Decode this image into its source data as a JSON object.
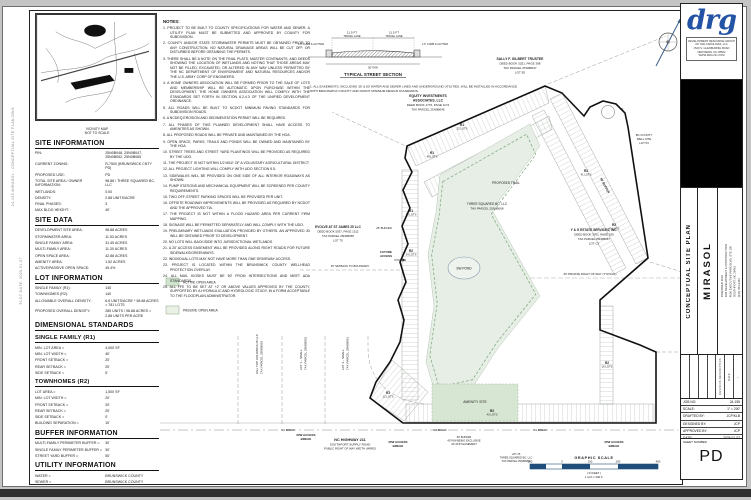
{
  "margin_notes": [
    "24-155 MIRASOL - CONCEPTUAL SITE PLAN.DWG",
    "PLOT DATE: 2025-01-07"
  ],
  "vicinity": {
    "caption": "VICINITY MAP",
    "scale_note": "NOT TO SCALE"
  },
  "sidebar": {
    "site_information": {
      "title": "SITE INFORMATION",
      "rows": [
        {
          "label": "PIN:",
          "value": "25N0B048, 25N0B047, 25N0B052, 25N0B065"
        },
        {
          "label": "CURRENT ZONING:",
          "value": "R-7500 (BRUNSWICK CNTY PD)"
        },
        {
          "label": "PROPOSED USE:",
          "value": "PD"
        },
        {
          "label": "TOTAL SITE AREA / OWNER INFORMATION:",
          "value": "98.88 / THREE SQUARED BC, LLC"
        },
        {
          "label": "WETLANDS:",
          "value": "0.00"
        },
        {
          "label": "DENSITY:",
          "value": "2.88 UNITS/ACRE"
        },
        {
          "label": "FINAL PHASES:",
          "value": "3"
        },
        {
          "label": "MAX BLDG HEIGHT:",
          "value": "40'"
        }
      ]
    },
    "site_data": {
      "title": "SITE DATA",
      "rows": [
        {
          "label": "DEVELOPMENT SITE AREA:",
          "value": "98.88 ACRES"
        },
        {
          "label": "STORMWATER AREA:",
          "value": "11.53 ACRES"
        },
        {
          "label": "SINGLE FAMILY AREA:",
          "value": "31.45 ACRES"
        },
        {
          "label": "MULTI-FAMILY AREA:",
          "value": "11.30 ACRES"
        },
        {
          "label": "OPEN SPACE AREA:",
          "value": "42.88 ACRES"
        },
        {
          "label": "AMENITY AREA:",
          "value": "1.52 ACRES"
        },
        {
          "label": "ACTIVE/PASSIVE OPEN SPACE:",
          "value": "49.4%"
        }
      ]
    },
    "lot_information": {
      "title": "LOT INFORMATION",
      "rows": [
        {
          "label": "SINGLE FAMILY (R1):",
          "value": "145"
        },
        {
          "label": "TOWNHOMES (R2):",
          "value": "140"
        },
        {
          "label": "ALLOWABLE OVERALL DENSITY:",
          "value": "6.8 UNITS/ACRE * 98.88 ACRES = 781 LOTS"
        },
        {
          "label": "PROPOSED OVERALL DENSITY:",
          "value": "285 UNITS / 98.88 ACRES = 2.88 UNITS PER ACRE"
        }
      ]
    },
    "dimensional_standards_title": "DIMENSIONAL STANDARDS",
    "single_family": {
      "title": "SINGLE FAMILY (R1)",
      "rows": [
        {
          "label": "MIN. LOT AREA =",
          "value": "4,000 SF"
        },
        {
          "label": "MIN. LOT WIDTH =",
          "value": "40'"
        },
        {
          "label": "FRONT SETBACK =",
          "value": "20'"
        },
        {
          "label": "REAR SETBACK =",
          "value": "20'"
        },
        {
          "label": "SIDE SETBACK =",
          "value": "5'"
        }
      ]
    },
    "townhomes": {
      "title": "TOWNHOMES (R2)",
      "rows": [
        {
          "label": "LOT AREA =",
          "value": "1,500 SF"
        },
        {
          "label": "MIN. LOT WIDTH =",
          "value": "20'"
        },
        {
          "label": "FRONT SETBACK =",
          "value": "20'"
        },
        {
          "label": "REAR SETBACK =",
          "value": "20'"
        },
        {
          "label": "SIDE SETBACK =",
          "value": "0'"
        },
        {
          "label": "BUILDING SEPARATION =",
          "value": "10'"
        }
      ]
    },
    "buffer_information": {
      "title": "BUFFER INFORMATION",
      "rows": [
        {
          "label": "MULTI-FAMILY PERIMETER BUFFER =",
          "value": "30'"
        },
        {
          "label": "SINGLE FAMILY PERIMETER BUFFER =",
          "value": "30'"
        },
        {
          "label": "STREET YARD BUFFER =",
          "value": "50'"
        }
      ]
    },
    "utility_information": {
      "title": "UTILITY INFORMATION",
      "rows": [
        {
          "label": "WATER =",
          "value": "BRUNSWICK COUNTY"
        },
        {
          "label": "SEWER =",
          "value": "BRUNSWICK COUNTY"
        }
      ]
    }
  },
  "notes": {
    "title": "NOTES:",
    "items": [
      "1. PROJECT TO BE BUILT TO COUNTY SPECIFICATIONS FOR WATER AND SEWER. A UTILITY PLAN MUST BE SUBMITTED AND APPROVED BY COUNTY FOR SUBDIVISION.",
      "2. COUNTY AND/OR STATE STORMWATER PERMITS MUST BE OBTAINED PRIOR TO ANY CONSTRUCTION. NO NATURAL DRAINAGE AREAS WILL BE CUT OFF OR DISTURBED BEFORE OBTAINING THE PERMITS.",
      "3. THERE SHALL BE A NOTE ON THE FINAL PLATS, MASTER COVENANTS, AND DEEDS SHOWING THE LOCATION OF WETLANDS AND NOTING THAT THOSE AREAS MAY NOT BE FILLED, EXCAVATED, OR ALTERED IN ANY WAY UNLESS PERMITTED BY THE NC DEPARTMENT OF ENVIRONMENT AND NATURAL RESOURCES AND/OR THE U.S. ARMY CORP OF ENGINEERS.",
      "4. A HOME OWNERS ASSOCIATION WILL BE FORMED PRIOR TO THE SALE OF LOTS AND MEMBERSHIP WILL BE AUTOMATIC UPON PURCHASE WITHIN THE DEVELOPMENT. THE HOME OWNERS ASSOCIATION WILL COMPLY WITH THE STANDARDS SET FORTH IN SECTION 6.2.4.3 OF THE UNIFIED DEVELOPMENT ORDINANCE.",
      "5. ALL ROADS WILL BE BUILT TO NCDOT MINIMUM PAVING STANDARDS FOR SUBDIVISION ROADS.",
      "6. A NCDEQ EROSION AND SEDIMENTATION PERMIT WILL BE REQUIRED.",
      "7. ALL PHASES OF THIS PLANNED DEVELOPMENT SHALL HAVE ACCESS TO AMENITIES AS SHOWN.",
      "8. ALL PROPOSED ROADS WILL BE PRIVATE AND MAINTAINED BY THE HOA.",
      "9. OPEN SPACE, PARKS, TRAILS AND PONDS WILL BE OWNED AND MAINTAINED BY THE HOA.",
      "10. STREET TREES AND STREET YARD PLANTINGS WILL BE PROVIDED AS REQUIRED BY THE UDO.",
      "11. THE PROJECT IS NOT WITHIN 1/2 MILE OF A VOLUNTARY AGRICULTURAL DISTRICT.",
      "12. ALL PROJECT LIGHTING WILL COMPLY WITH UDO SECTION 5.5.",
      "13. SIDEWALKS WILL BE PROVIDED ON ONE SIDE OF ALL INTERIOR ROADWAYS AS SHOWN.",
      "14. PUMP STATIONS AND MECHANICAL EQUIPMENT WILL BE SCREENED PER COUNTY REQUIREMENTS.",
      "15. TWO OFF-STREET PARKING SPACES WILL BE PROVIDED PER UNIT.",
      "16. OFFSITE ROADWAY IMPROVEMENTS WILL BE PROVIDED AS REQUIRED BY NCDOT AND THE APPROVED TIA.",
      "17. THE PROJECT IS NOT WITHIN A FLOOD HAZARD AREA PER CURRENT FIRM MAPPING.",
      "18. SIGNAGE WILL BE PERMITTED SEPARATELY AND WILL COMPLY WITH THE UDO.",
      "19. PRELIMINARY WETLANDS EVALUATION PROVIDED BY OTHERS. AN APPROVED JD WILL BE OBTAINED PRIOR TO DEVELOPMENT.",
      "20. NO LOTS WILL BACK/SIDE INTO JURISDICTIONAL WETLANDS.",
      "21. A 20' ACCESS EASEMENT WILL BE PROVIDED ALONG RIGHT ROADS FOR FUTURE SIDEWALKS/GREENWAYS.",
      "22. INDIVIDUAL LOTS MAY NOT HAVE MORE THAN ONE DRIVEWAY ACCESS.",
      "23. PROJECT IS LOCATED WITHIN THE BRUNSWICK COUNTY WELLHEAD PROTECTION OVERLAY.",
      "24. ALL MAIL KIOSKS MUST BE 50' FROM INTERSECTIONS AND MEET ADA STANDARDS.",
      "25. ALL FFE TO BE SET AT +2' OR ABOVE VALUES APPROVED BY THE COUNTY, SUPPORTED BY A HYDRAULIC AND HYDROLOGIC STUDY, IN A FORM ACCEPTABLE TO THE FLOODPLAIN ADMINISTRATOR."
    ]
  },
  "street_section": {
    "title": "TYPICAL STREET SECTION",
    "lane_left_dim": "11.5 FT",
    "lane_left_name": "TRAVEL LANE",
    "lane_right_dim": "11.5 FT",
    "lane_right_name": "TRAVEL LANE",
    "curb_left": "1.5' CURB & GUTTER",
    "curb_right": "1.5' CURB & GUTTER",
    "bottom_dim": "50' R/W",
    "notes": [
      "1. ALL EASEMENTS, INCLUDING 30' & 50' WATER AND SEWER LINES AND UNDERGROUND UTILITIES, WILL BE INSTALLED IN ACCORDANCE",
      "WITH BRUNSWICK COUNTY AND NCDOT MINIMUM DESIGN STANDARDS."
    ]
  },
  "legend": {
    "items": [
      {
        "label": "ACTIVE OPEN AREA",
        "color": "#cfe3cd"
      },
      {
        "label": "PASSIVE OPEN AREA",
        "color": "#e9f1e7"
      }
    ]
  },
  "plan": {
    "sally": [
      "SALLY F. GILBERT TRUSTEE",
      "DEED BOOK 3251, PAGE 398",
      "TAX PARCEL 25N0B047",
      "LOT 55"
    ],
    "equity": [
      "EQUITY INVESTMENTS",
      "ASSOCIATES, LLC",
      "DEED BOOK 1776, PAGE 1174",
      "TAX PARCEL 25N0B046"
    ],
    "evolve": [
      "EVOLVE AT ST JAMES 25 LLC",
      "DEED BOOK 5037, PAGE 1512",
      "TAX PARCEL 25N0B065",
      "LOT 75"
    ],
    "yg": [
      "Y & G ESTATE SERVICES, INC.",
      "DEED BOOK 3761, PAGE 529",
      "TAX PARCEL 25N0B067",
      "LOT C3"
    ],
    "well": [
      "BC COUNTY",
      "WELL SITE",
      "LOT 54"
    ],
    "owner_center": [
      "THREE SQUARED BC, LLC",
      "TAX PARCEL 25N0B068"
    ],
    "hilltop": [
      "HILL TOP HOLDINGS 25 LLC",
      "TAX PARCEL 25N0B063"
    ],
    "lot1": [
      "LOT 1 - SMALL",
      "TAX PARCEL 25N0B062"
    ],
    "lot2": [
      "LOT 2 - SMALL",
      "TAX PARCEL 25N0B061"
    ],
    "lot25": [
      "LOT 25",
      "THREE SQUARED BC, LLC",
      "TAX PARCEL 25N0B052"
    ],
    "buffer_ne": "50' BUFFER",
    "buffer_left": "25' BUFFER",
    "buffer_bottom": [
      "50' BUFFER",
      "40' R/W BEING EXCLUSIVE",
      "OF AT&T EASEMENT"
    ],
    "future_access": [
      "FUTURE",
      "ACCESS"
    ],
    "setback": "25' SETBACK TO BOUNDARY",
    "private_row": "60' PRIVATE RIGHT OF WAY (TYPICAL)",
    "trail": "PROPOSED TRAIL",
    "pond": "SW POND",
    "amenity": "AMENITY SITE",
    "culdesac": "C1",
    "zones": [
      {
        "z": "R1",
        "n": "22 LOTS"
      },
      {
        "z": "R1",
        "n": "45 LOTS"
      },
      {
        "z": "R1",
        "n": "18 LOTS"
      },
      {
        "z": "R2",
        "n": "14 LOTS"
      },
      {
        "z": "R2",
        "n": "41 LOTS"
      },
      {
        "z": "R2",
        "n": "40 LOTS"
      },
      {
        "z": "R2",
        "n": "16 LOTS"
      },
      {
        "z": "R2",
        "n": "40 LOTS"
      },
      {
        "z": "R1",
        "n": "12 LOTS"
      }
    ],
    "access_break": [
      "R/W ACCESS",
      "BREAK"
    ],
    "cl_break": "C/L BREAK",
    "highway": [
      "NC HIGHWAY 211",
      "SOUTHPORT SUPPLY ROAD",
      "PUBLIC RIGHT OF WAY WIDTH VARIES"
    ]
  },
  "graphic_scale": {
    "title": "GRAPHIC SCALE",
    "ticks": [
      "100",
      "0",
      "100",
      "200",
      "400"
    ],
    "in_feet": "( IN FEET )",
    "ratio": "1 inch = 200 ft.",
    "bar_color": "#1f4e7a"
  },
  "title_block": {
    "logo": "drg",
    "firm_lines": [
      "DEVELOPMENT RESOURCE GROUP",
      "OF THE CAROLINAS, LLC",
      "1540 S. GLENBURNIE ROAD",
      "NEW BERN, NC 28562",
      "WWW.DRG-NC.COM"
    ],
    "sheet_title": "CONCEPTUAL SITE PLAN",
    "project_name": "MIRASOL",
    "prepared_for": [
      "PREPARED FOR:",
      "DLB DEVELOPMENT & CONSTRUCTION",
      "4006 EXECUTIVE PARK BLVD, STE 100",
      "SOUTHPORT, NC 28461",
      "(910) 454-4443"
    ],
    "rev_date_label": "DATE",
    "rev_desc_label": "REVISION DESCRIPTION",
    "rev_mark": "-",
    "info_rows": [
      {
        "label": "JOB NO:",
        "value": "24-155"
      },
      {
        "label": "SCALE:",
        "value": "1\" = 200'"
      },
      {
        "label": "DRAFTED BY:",
        "value": "JCP/KLB"
      },
      {
        "label": "DESIGNED BY:",
        "value": "JCP"
      },
      {
        "label": "APPROVED BY:",
        "value": "JCP"
      },
      {
        "label": "DATE:",
        "value": "2025-01-07"
      }
    ],
    "sheet_number_label": "SHEET NUMBER",
    "sheet_number": "PD"
  }
}
